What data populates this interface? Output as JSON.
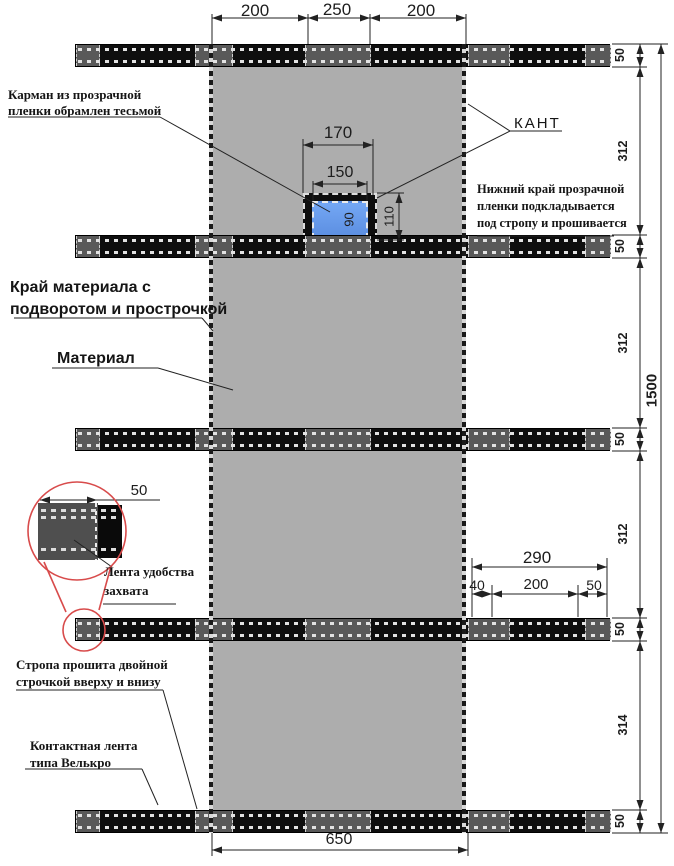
{
  "annotations": {
    "pocket": {
      "line1": "Карман из прозрачной",
      "line2": "пленки обрамлен тесьмой"
    },
    "kant": "КАНТ",
    "film_bottom": {
      "line1": "Нижний край прозрачной",
      "line2": "пленки подкладывается",
      "line3": "под стропу и прошивается"
    },
    "material_edge": {
      "line1": "Край материала с",
      "line2": "подворотом и прострочкой"
    },
    "material": "Материал",
    "grip_tape": {
      "line1": "Лента удобства",
      "line2": "захвата"
    },
    "strap_stitch": {
      "line1": "Стропа прошита двойной",
      "line2": "строчкой вверху и внизу"
    },
    "velcro": {
      "line1": "Контактная лента",
      "line2": "типа Велькро"
    }
  },
  "dimensions": {
    "top": [
      "200",
      "250",
      "200"
    ],
    "pocket_outer_width": "170",
    "pocket_inner_width": "150",
    "pocket_total_height": "110",
    "pocket_visible_height": "90",
    "strap_height": "50",
    "panel_heights": [
      "312",
      "312",
      "312",
      "314"
    ],
    "total_height": "1500",
    "strap_right_total": "290",
    "strap_right_parts": [
      "40",
      "200",
      "50"
    ],
    "material_width": "650",
    "grip_tape_width": "50"
  },
  "colors": {
    "material": "#adadad",
    "strap": "#0e0e0e",
    "strap_light": "#595959",
    "pocket_film": "#74a7f4",
    "detail_red": "#d84b4b"
  }
}
